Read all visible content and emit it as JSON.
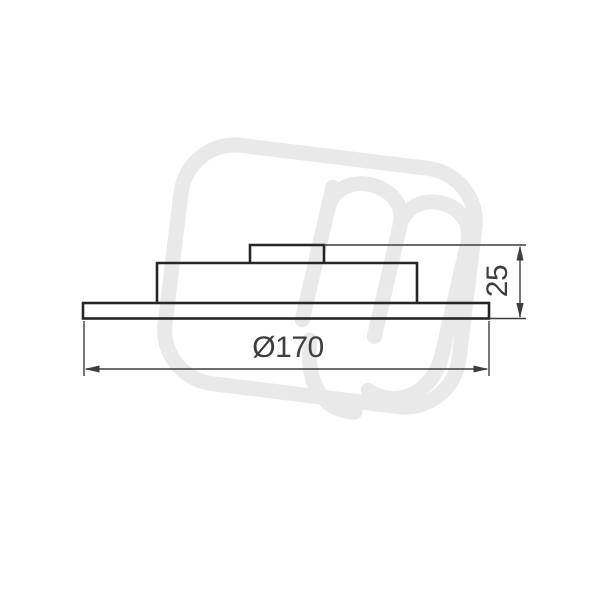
{
  "page": {
    "background": "#ffffff"
  },
  "drawing": {
    "type": "technical-dimension-drawing-side-view",
    "dimensions": {
      "diameter": {
        "label": "Ø170"
      },
      "height": {
        "label": "25"
      }
    },
    "line_color": "#262626",
    "dimension_color": "#3d3d3d",
    "watermark_color": "#e9e9e9"
  }
}
